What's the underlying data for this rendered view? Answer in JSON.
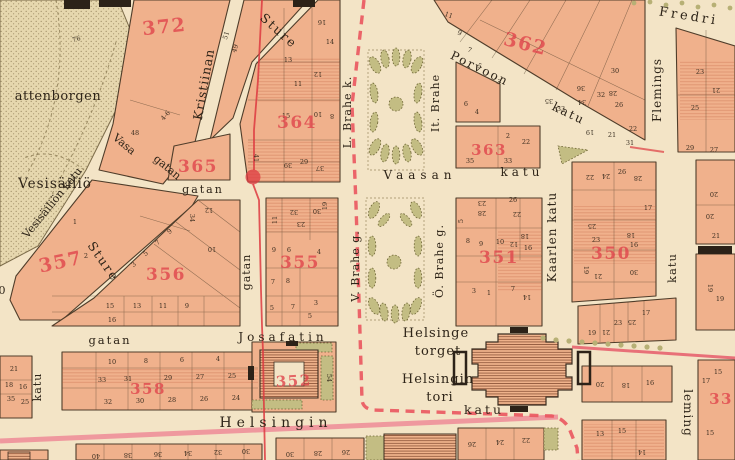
{
  "colors": {
    "paper": "#f3e4c6",
    "block": "#f0b18c",
    "block_line": "#4f3d2a",
    "park_green": "#c3bd83",
    "red_accent": "#e0454c",
    "boundary_red": "#ea555e",
    "tram_red": "#dd3a40",
    "street_pink": "#ee8f99",
    "reservoir": "#e6d7ae",
    "ink": "#2e2418"
  },
  "labels": {
    "vattenborgen": "attenborgen",
    "vesisailio": "Vesisäiliö",
    "vesisailion_katu": "Vesisäiliön katu",
    "vasa": "Vasa",
    "vasa_gatan2": "gatan",
    "kristiinan": "Kristiinan",
    "sture_upper": "Sture",
    "sture_lower": "Sture",
    "gatan_mid": "gatan",
    "gatan_vertical": "gatan",
    "gatan_west": "gatan",
    "josafatin": "Josafatin",
    "l_brahe": "L. Brahe k.",
    "v_brahe": "V. Brahe g.",
    "it_brahe": "It. Brahe",
    "o_brahe": "Ö. Brahe g.",
    "vaasan": "Vaasan",
    "vaasan_katu": "katu",
    "porvoon": "Porvoon",
    "porvoon_katu": "katu",
    "fredri": "Fredri",
    "flemings": "Flemings",
    "fleming_katu": "katu",
    "leming": "leming",
    "kaarlen_katu": "Kaarlen katu",
    "katu_west": "katu",
    "helsingin": "Helsingin",
    "helsingin_katu2": "katu",
    "helsinge_torget_1": "Helsinge",
    "helsinge_torget_2": "torget",
    "helsingin_tori_1": "Helsingin",
    "helsingin_tori_2": "tori",
    "corner_zero": "0"
  },
  "blocks": {
    "b372": {
      "number": "372",
      "lots": [
        "76",
        "48",
        "4-6",
        "51",
        "49"
      ]
    },
    "b364": {
      "number": "364",
      "lots": [
        "16",
        "14",
        "12",
        "11",
        "13",
        "15",
        "10",
        "8",
        "39",
        "29",
        "37",
        "41"
      ]
    },
    "b365": {
      "number": "365"
    },
    "b357": {
      "number": "357",
      "lots": [
        "1",
        "2"
      ]
    },
    "b356": {
      "number": "356",
      "lots": [
        "34",
        "12",
        "10",
        "9",
        "7",
        "5",
        "3",
        "15",
        "13",
        "11",
        "9",
        "16"
      ]
    },
    "b355": {
      "number": "355",
      "lots": [
        "32",
        "23",
        "30",
        "19",
        "11",
        "9",
        "6",
        "4",
        "8",
        "7",
        "5",
        "3",
        "7",
        "5"
      ]
    },
    "b358": {
      "number": "358",
      "lots": [
        "10",
        "8",
        "6",
        "4",
        "33",
        "31",
        "29",
        "27",
        "25",
        "32",
        "30",
        "28",
        "26",
        "24"
      ]
    },
    "b352": {
      "number": "352",
      "lots": [
        "54"
      ]
    },
    "b362": {
      "number": "362",
      "lots": [
        "11",
        "9",
        "7",
        "5",
        "3",
        "36",
        "34",
        "32",
        "30",
        "28",
        "26",
        "22",
        "35",
        "33",
        "19",
        "21",
        "31"
      ]
    },
    "b363": {
      "number": "363",
      "lots": [
        "2",
        "22",
        "35",
        "33"
      ]
    },
    "b363n": {
      "lots": [
        "6",
        "4"
      ]
    },
    "b351": {
      "number": "351",
      "lots": [
        "5",
        "28",
        "23",
        "26",
        "22",
        "8",
        "6",
        "10",
        "12",
        "18",
        "16",
        "3",
        "1",
        "7",
        "14"
      ]
    },
    "b350": {
      "number": "350",
      "lots": [
        "22",
        "24",
        "26",
        "28",
        "18",
        "16",
        "25",
        "23",
        "19",
        "21",
        "30",
        "17"
      ]
    },
    "b350s": {
      "lots": [
        "19",
        "21",
        "23",
        "25",
        "17"
      ]
    },
    "btr": {
      "lots": [
        "23",
        "21",
        "25",
        "29",
        "27"
      ]
    },
    "brm": {
      "lots": [
        "20",
        "20",
        "21",
        "19",
        "19"
      ]
    },
    "bre": {
      "number": "33",
      "lots": [
        "17",
        "15",
        "15"
      ]
    },
    "bw": {
      "lots": [
        "21",
        "18",
        "16",
        "35",
        "25"
      ]
    },
    "br1": {
      "lots": [
        "20",
        "18",
        "16"
      ]
    },
    "bm1": {
      "lots": [
        "40",
        "38",
        "36",
        "34",
        "32",
        "30"
      ]
    },
    "bm2": {
      "lots": [
        "30",
        "28",
        "26"
      ]
    },
    "bm4": {
      "lots": [
        "26",
        "24",
        "22"
      ]
    },
    "bm5": {
      "lots": [
        "13",
        "15",
        "14"
      ]
    }
  }
}
